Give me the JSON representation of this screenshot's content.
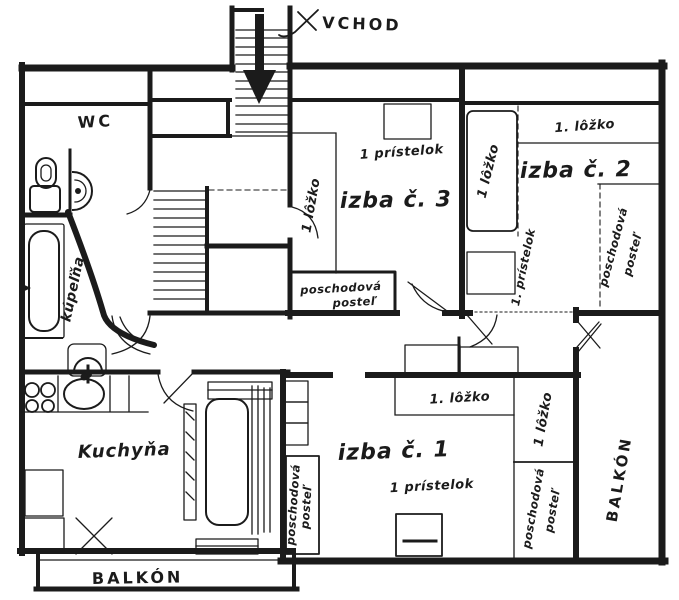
{
  "plan": {
    "entrance_label": "VCHOD",
    "rooms": {
      "wc": "WC",
      "bathroom": "kúpeľňa",
      "kitchen": "Kuchyňa",
      "room1": "izba č. 1",
      "room2": "izba č. 2",
      "room3": "izba č. 3",
      "balcony_bottom": "BALKÓN",
      "balcony_right": "BALKÓN"
    },
    "beds": {
      "lozko_num": "1. lôžko",
      "lozko": "1 lôžko",
      "pristelok": "1 prístelok",
      "pristelok_num": "1. prístelok",
      "bunk_line1": "poschodová",
      "bunk_line2": "posteľ"
    },
    "ink_color": "#1b1b1b",
    "paper_color": "#ffffff"
  }
}
